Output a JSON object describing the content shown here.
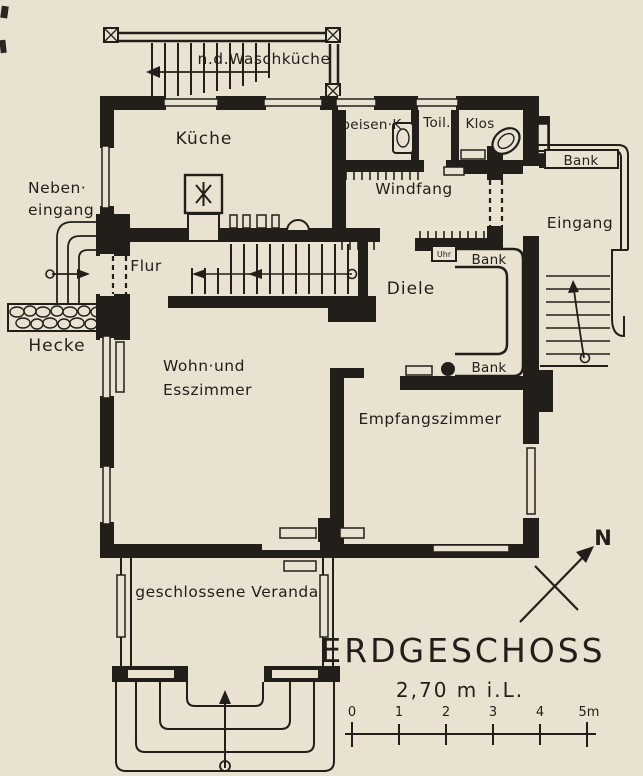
{
  "title": {
    "heading": "ERDGESCHOSS",
    "subtitle": "2,70 m i.L."
  },
  "compass": {
    "north": "N"
  },
  "scale": {
    "ticks": [
      "0",
      "1",
      "2",
      "3",
      "4",
      "5m"
    ]
  },
  "rooms": {
    "basement_stairs": "n.d.Waschküche",
    "kitchen": "Küche",
    "pantry": "Speisen·K",
    "toilet": "Toil.",
    "wc": "Klos",
    "vestibule": "Windfang",
    "hallway": "Flur",
    "hall": "Diele",
    "living_line1": "Wohn·und",
    "living_line2": "Esszimmer",
    "reception": "Empfangszimmer",
    "veranda": "geschlossene Veranda",
    "entrance": "Eingang",
    "side_entrance_line1": "Neben·",
    "side_entrance_line2": "eingang",
    "hedge": "Hecke"
  },
  "furniture": {
    "bench": "Bank",
    "clock": "Uhr"
  },
  "colors": {
    "paper": "#e9e2d1",
    "ink": "#221f1b"
  }
}
